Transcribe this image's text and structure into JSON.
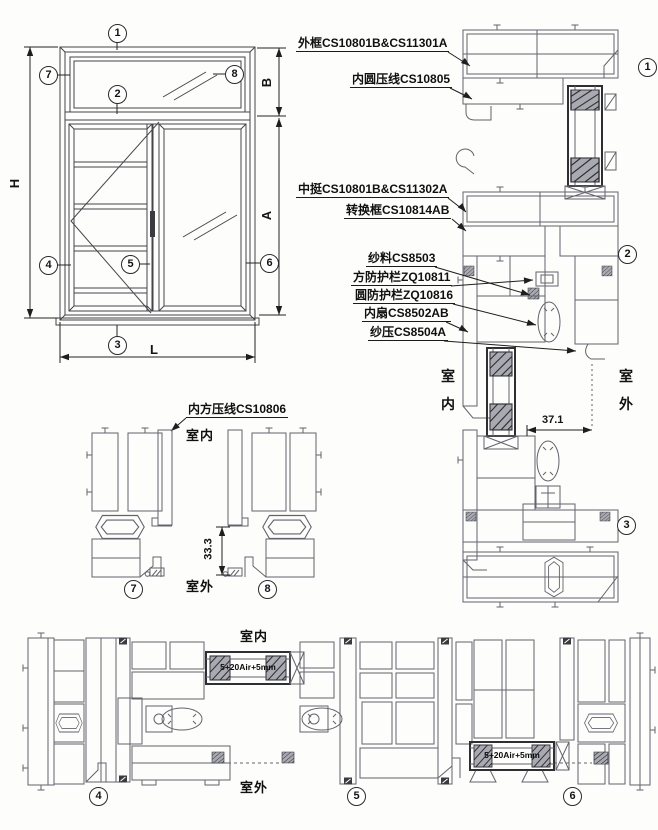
{
  "page": {
    "background": "#fdfdfb",
    "profile_line_color": "#63636d",
    "elevation_line_color": "#45454b",
    "text_color": "#101010"
  },
  "labels": {
    "outer_frame": "外框CS10801B&CS11301A",
    "inner_round_bead": "内圆压线CS10805",
    "mullion": "中挺CS10801B&CS11302A",
    "adapter_frame": "转换框CS10814AB",
    "screen_mesh": "纱料CS8503",
    "square_guard_rail": "方防护栏ZQ10811",
    "round_guard_rail": "圆防护栏ZQ10816",
    "inner_sash": "内扇CS8502AB",
    "screen_bead": "纱压CS8504A",
    "inner_square_bead": "内方压线CS10806"
  },
  "sides": {
    "indoor": "室内",
    "outdoor": "室外",
    "indoor_char_1": "室",
    "indoor_char_2": "内",
    "outdoor_char_1": "室",
    "outdoor_char_2": "外"
  },
  "dimensions": {
    "height": "H",
    "width": "L",
    "lower_height": "A",
    "upper_height": "B",
    "offset_37": "37.1",
    "offset_33": "33.3",
    "glass_spec": "5+20Air+5mm"
  },
  "callouts": {
    "n1": "1",
    "n2": "2",
    "n3": "3",
    "n4": "4",
    "n5": "5",
    "n6": "6",
    "n7": "7",
    "n8": "8"
  }
}
